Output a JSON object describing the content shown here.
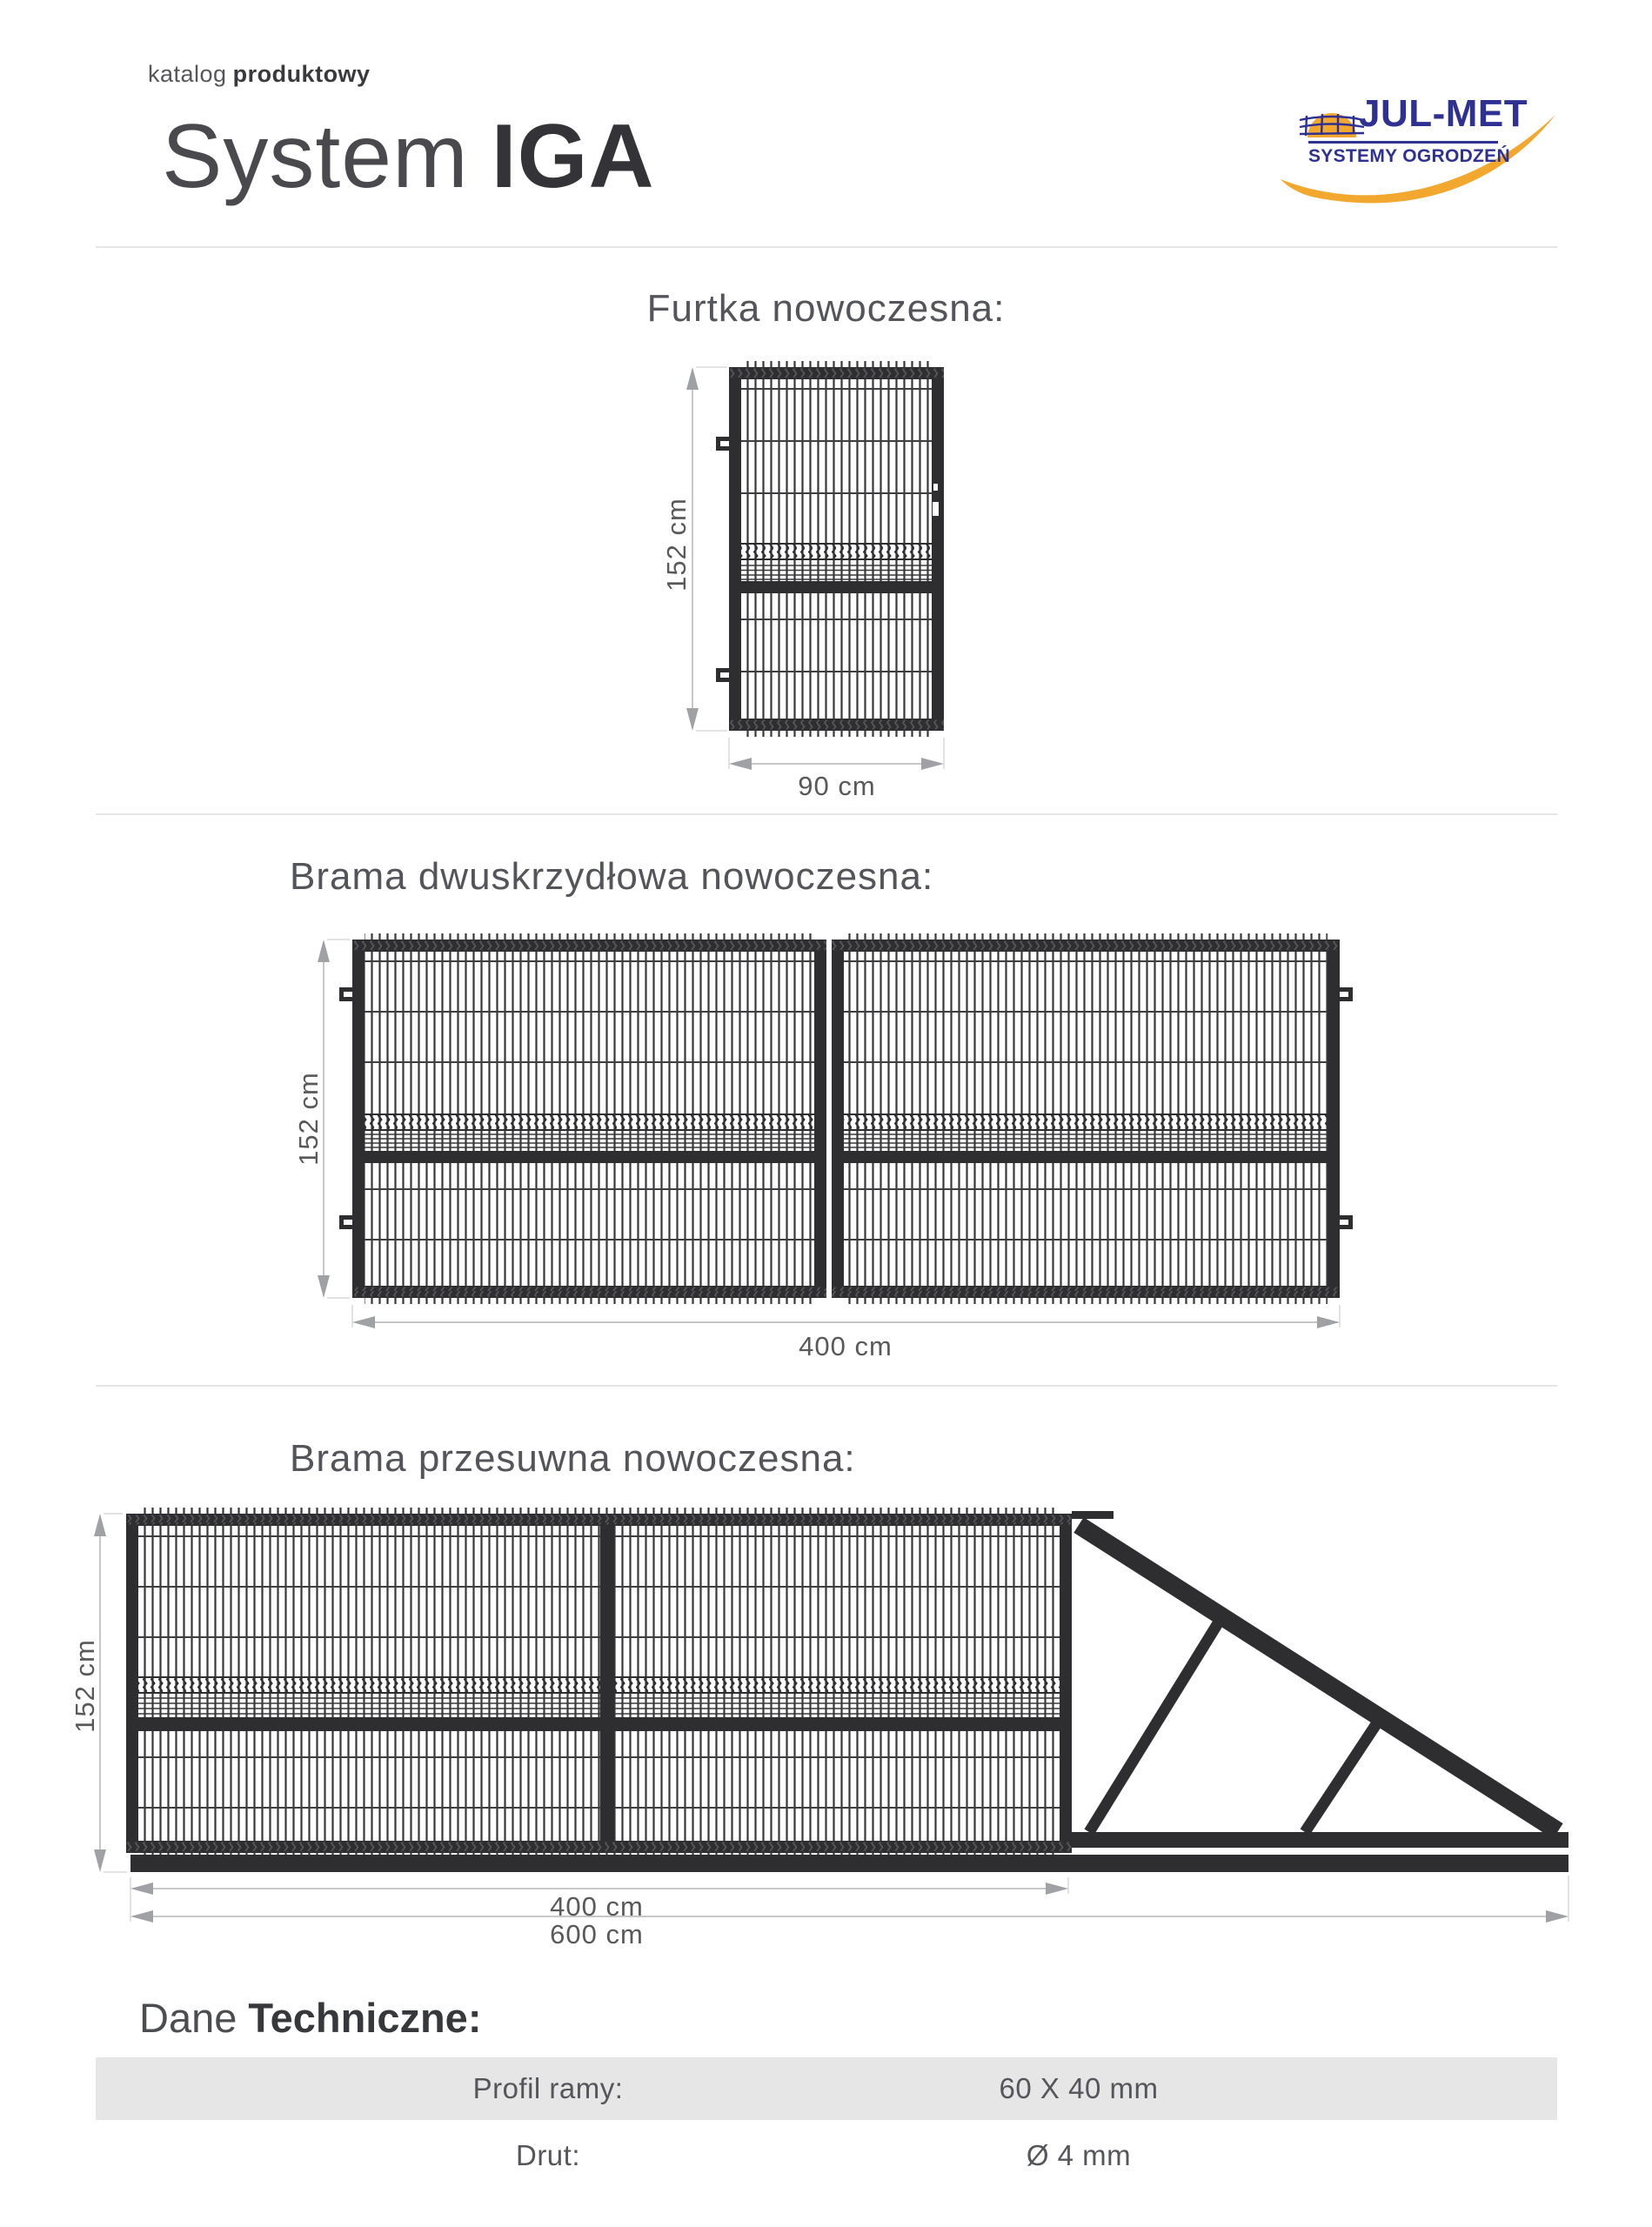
{
  "header": {
    "eyebrow_light": "katalog",
    "eyebrow_bold": "produktowy",
    "title_light": "System",
    "title_bold": "IGA"
  },
  "logo": {
    "name": "JUL-MET",
    "subtitle": "SYSTEMY OGRODZEŃ",
    "colors": {
      "blue": "#2e3192",
      "yellow": "#f2a72e"
    }
  },
  "sections": [
    {
      "heading": "Furtka nowoczesna:",
      "dim_height": "152 cm",
      "dim_width": "90 cm"
    },
    {
      "heading": "Brama dwuskrzydłowa nowoczesna:",
      "dim_height": "152 cm",
      "dim_width": "400 cm"
    },
    {
      "heading": "Brama przesuwna nowoczesna:",
      "dim_height": "152 cm",
      "dim_width_panel": "400 cm",
      "dim_width_total": "600 cm"
    }
  ],
  "tech": {
    "heading_light": "Dane",
    "heading_bold": "Techniczne:",
    "rows": [
      {
        "label": "Profil ramy:",
        "value": "60 X 40 mm"
      },
      {
        "label": "Drut:",
        "value": "Ø 4 mm"
      }
    ]
  },
  "colors": {
    "drawing_frame": "#2e2e30",
    "dimension_arrow": "#9fa1a4",
    "dimension_label": "#58595b",
    "divider": "#e5e5e6",
    "table_row_gray": "#e6e6e7"
  }
}
